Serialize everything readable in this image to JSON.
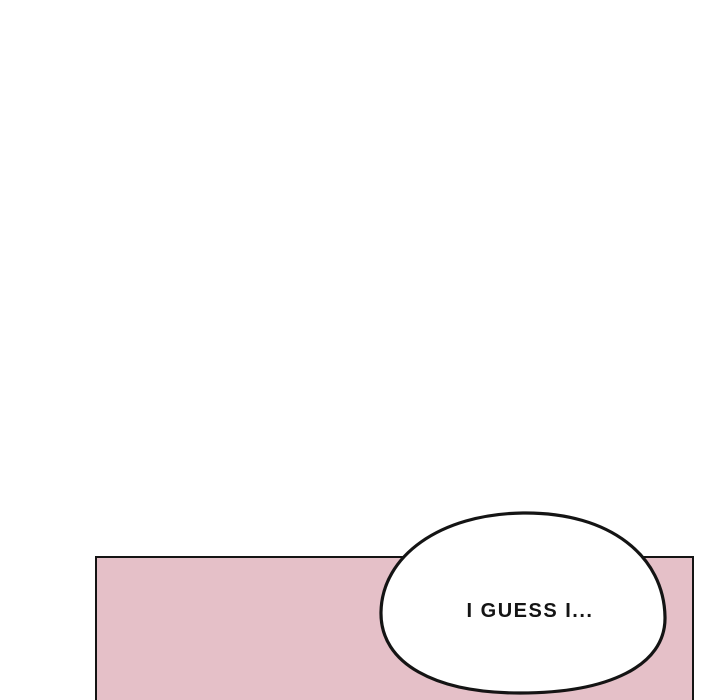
{
  "colors": {
    "page_background": "#ffffff",
    "panel_fill": "#e5c0c8",
    "line": "#141414",
    "bubble_fill": "#ffffff",
    "text": "#141414"
  },
  "speech_bubble": {
    "text": "I GUESS I..."
  }
}
